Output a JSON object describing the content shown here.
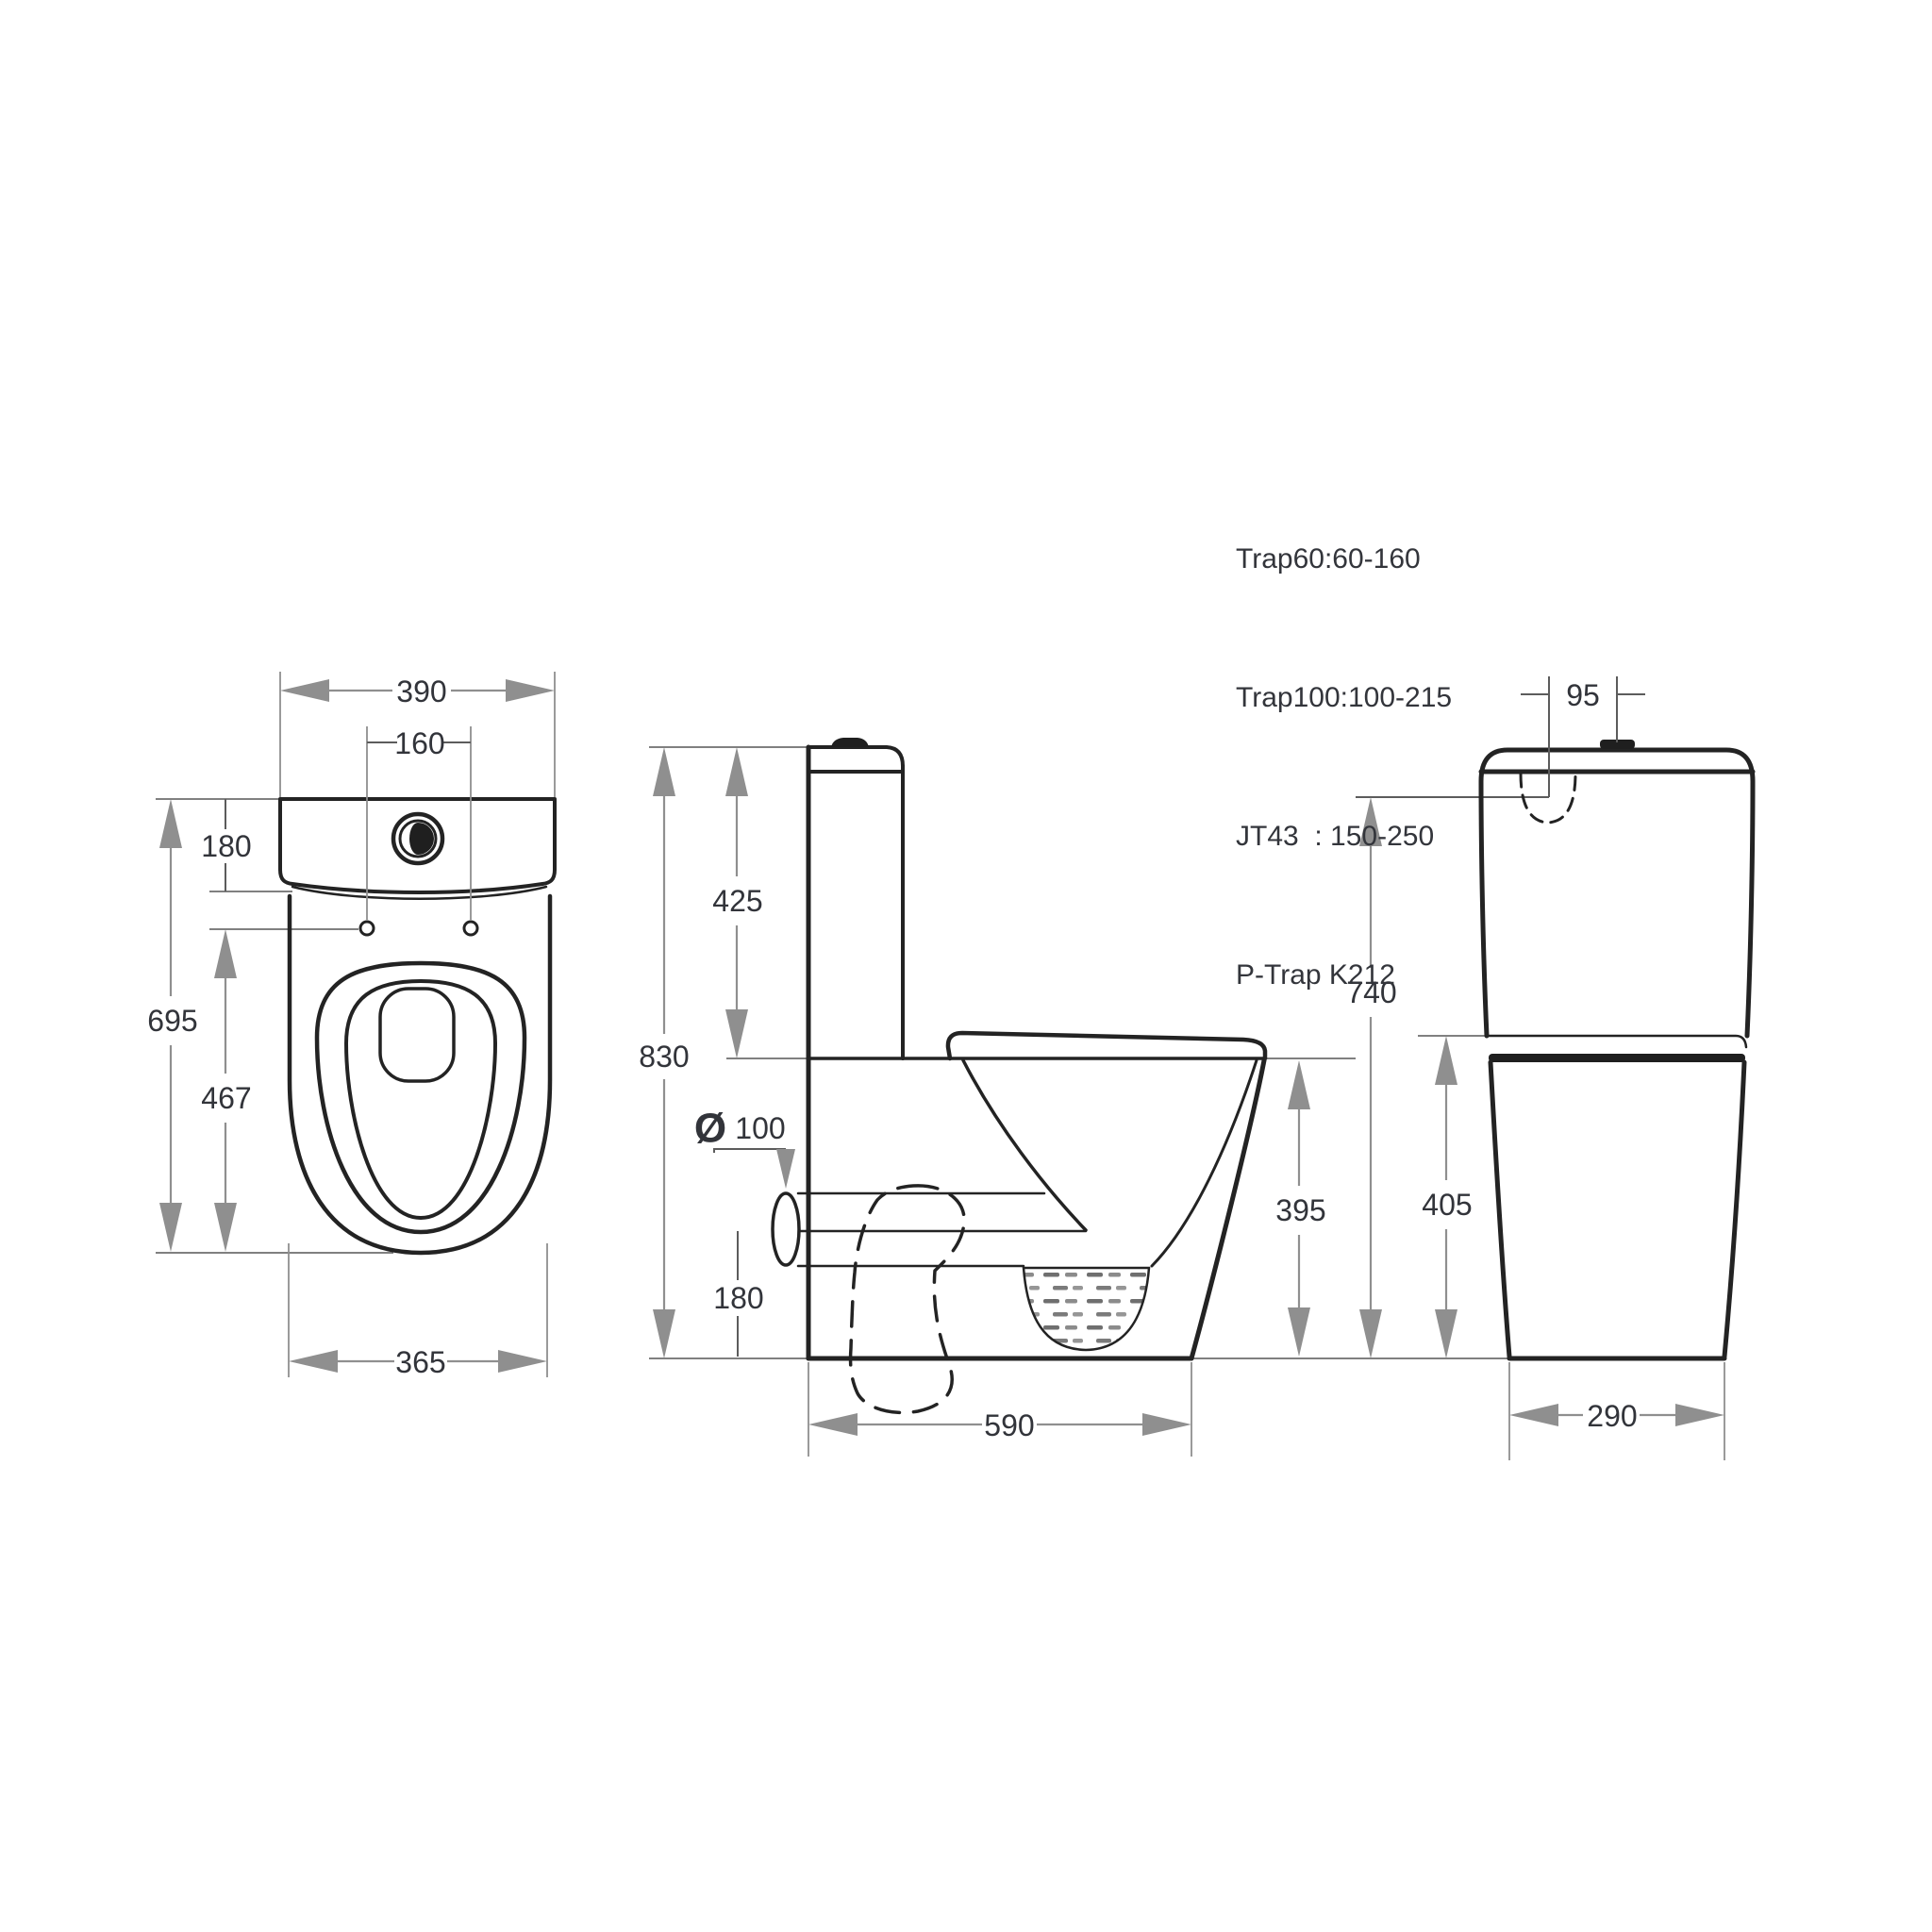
{
  "notes": {
    "lines": [
      "Trap60:60-160",
      "Trap100:100-215",
      "JT43  : 150-250",
      "P-Trap K212"
    ]
  },
  "top_view": {
    "width_top": "390",
    "hole_spacing": "160",
    "tank_depth": "180",
    "total_length": "695",
    "holes_to_front": "467",
    "width_bottom": "365"
  },
  "side_view": {
    "tank_height": "425",
    "total_height": "830",
    "outlet_diameter_symbol": "Ø",
    "outlet_diameter": "100",
    "outlet_center_height": "180",
    "rim_height": "395",
    "total_depth": "590"
  },
  "front_view": {
    "button_offset": "95",
    "lid_height": "740",
    "bowl_height": "405",
    "base_width": "290"
  },
  "colors": {
    "background": "#ffffff",
    "drawing_line": "#232323",
    "dimension_gray": "#8f8f8f",
    "text": "#32343a"
  }
}
